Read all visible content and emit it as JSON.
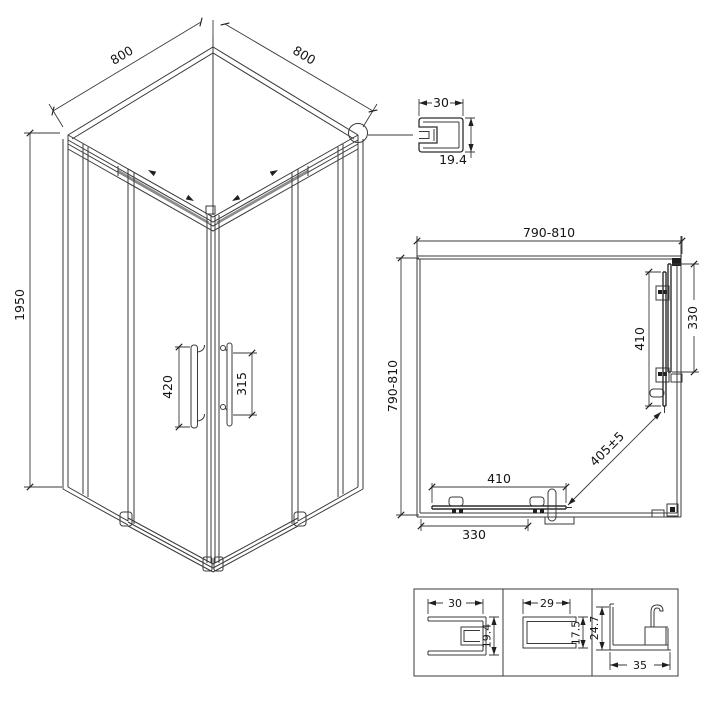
{
  "figure": {
    "type": "shower-enclosure-technical-drawing",
    "background": "#ffffff",
    "line_color": "#3a3a3a",
    "isometric_view": {
      "dim_top_left_edge": "800",
      "dim_top_right_edge": "800",
      "dim_height": "1950",
      "dim_left_handle": "420",
      "dim_right_handle": "315"
    },
    "corner_profile_detail": {
      "dim_width": "30",
      "dim_height": "19.4"
    },
    "plan_view": {
      "dim_width_top": "790-810",
      "dim_depth_left": "790-810",
      "dim_right_fixed_panel": "330",
      "dim_right_door": "410",
      "dim_bottom_door": "410",
      "dim_bottom_fixed_panel": "330",
      "dim_diagonal_entry": "405±5"
    },
    "profile_details": [
      {
        "dim_width": "30",
        "dim_height": "19.4"
      },
      {
        "dim_width": "29",
        "dim_height": "17.5"
      },
      {
        "dim_width": "35",
        "dim_height": "24.7"
      }
    ]
  }
}
